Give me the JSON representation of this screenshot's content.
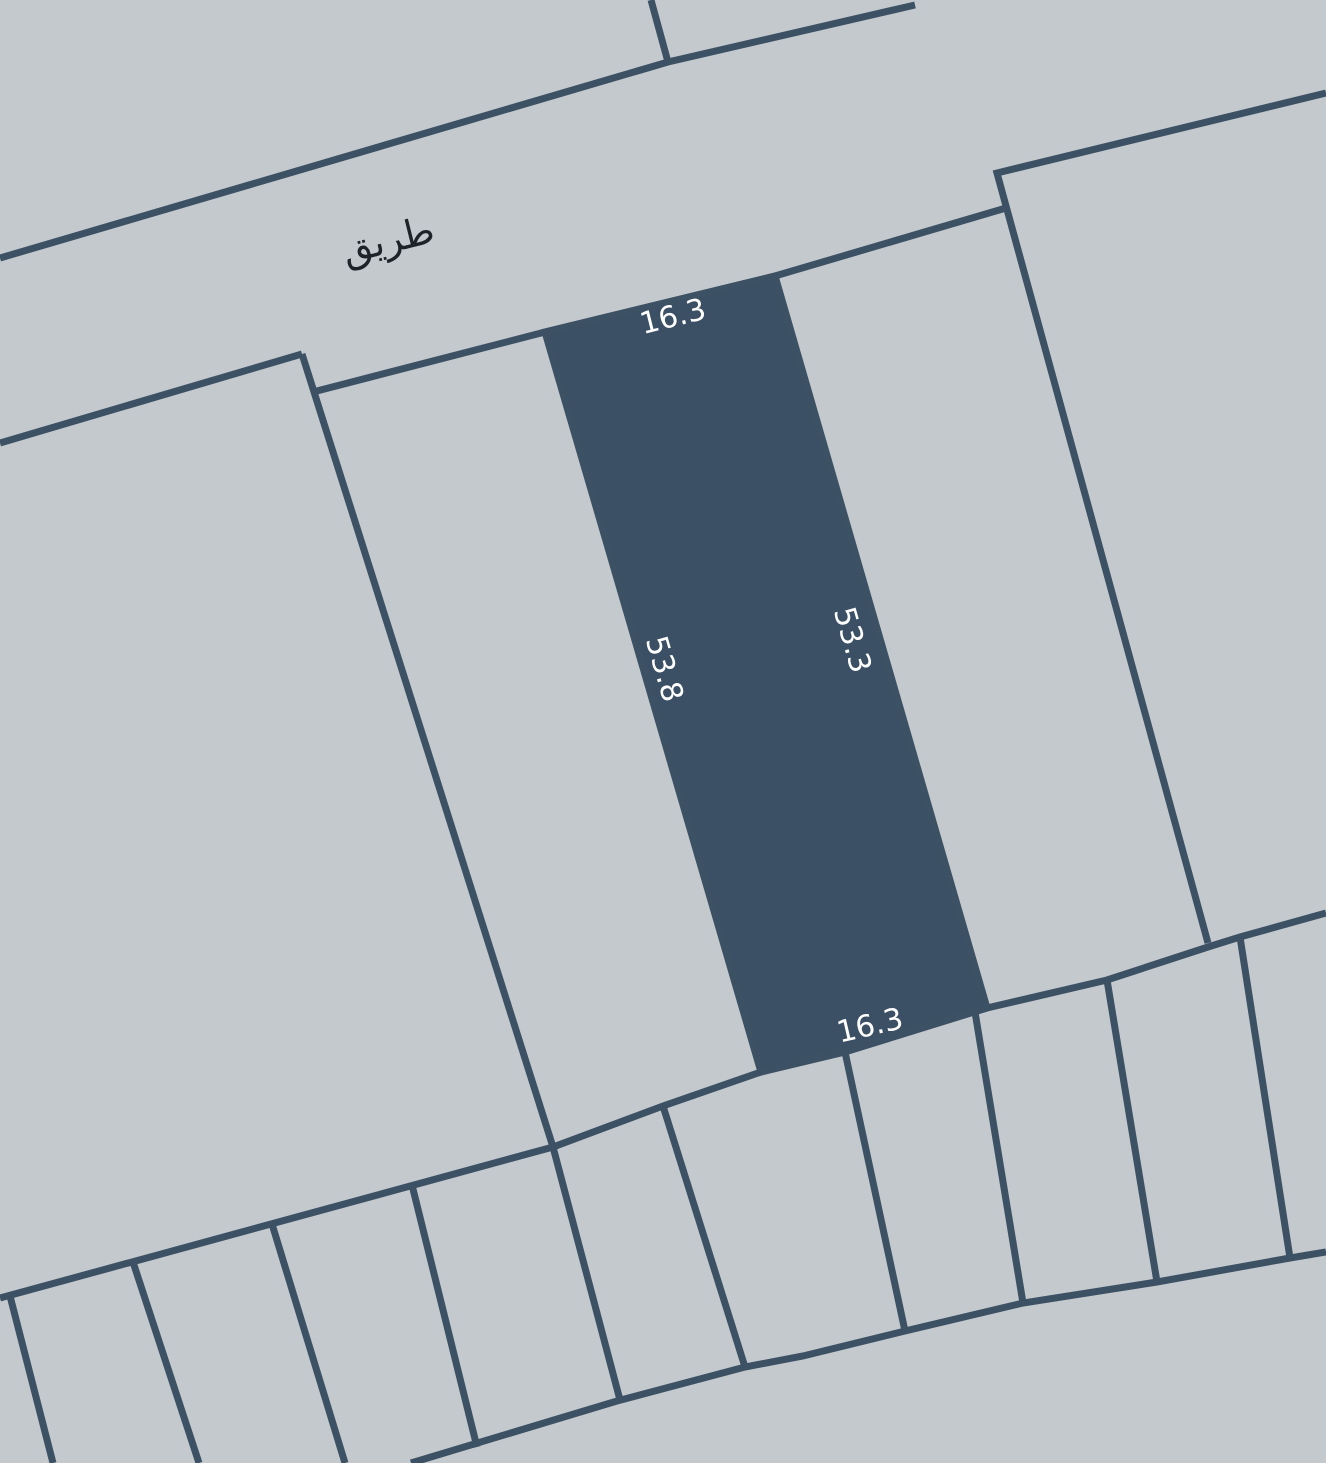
{
  "map": {
    "background_color": "#c4c9cd",
    "boundary_color": "#3d5165",
    "boundary_width": 7,
    "selected_parcel": {
      "fill_color": "#3b5064",
      "points": [
        [
          545,
          332
        ],
        [
          775,
          276
        ],
        [
          987,
          1008
        ],
        [
          761,
          1072
        ]
      ],
      "dimensions": {
        "top": {
          "text": "16.3",
          "x": 673,
          "y": 317,
          "rotate": -14,
          "color": "#ffffff",
          "size": 30
        },
        "right": {
          "text": "53.3",
          "x": 852,
          "y": 640,
          "rotate": 74,
          "color": "#ffffff",
          "size": 30
        },
        "left": {
          "text": "53.8",
          "x": 664,
          "y": 669,
          "rotate": 74,
          "color": "#ffffff",
          "size": 30
        },
        "bottom": {
          "text": "16.3",
          "x": 870,
          "y": 1026,
          "rotate": -13,
          "color": "#ffffff",
          "size": 30
        }
      }
    },
    "road_label": {
      "text": "طريق",
      "x": 388,
      "y": 240,
      "rotate": -14,
      "color": "#1e2329",
      "size": 38
    },
    "boundaries": [
      {
        "id": "road-north-edge",
        "points": [
          [
            0,
            258
          ],
          [
            668,
            62
          ],
          [
            915,
            5
          ]
        ]
      },
      {
        "id": "north-lot-line",
        "points": [
          [
            651,
            0
          ],
          [
            668,
            62
          ]
        ]
      },
      {
        "id": "west-block-north-edge",
        "points": [
          [
            0,
            443
          ],
          [
            302,
            354
          ]
        ]
      },
      {
        "id": "road-south-edge",
        "points": [
          [
            313,
            392
          ],
          [
            545,
            332
          ],
          [
            775,
            276
          ],
          [
            1006,
            208
          ]
        ]
      },
      {
        "id": "east-block-west-edge",
        "points": [
          [
            1326,
            93
          ],
          [
            997,
            173
          ],
          [
            1208,
            943
          ]
        ]
      },
      {
        "id": "west-strip-edge",
        "points": [
          [
            302,
            354
          ],
          [
            553,
            1147
          ]
        ]
      },
      {
        "id": "lower-block-north-edge",
        "points": [
          [
            0,
            1298
          ],
          [
            553,
            1147
          ],
          [
            663,
            1106
          ],
          [
            761,
            1072
          ],
          [
            845,
            1052
          ],
          [
            987,
            1008
          ],
          [
            1107,
            980
          ],
          [
            1208,
            947
          ],
          [
            1240,
            937
          ],
          [
            1326,
            913
          ]
        ]
      },
      {
        "id": "lower-row-south-edge",
        "points": [
          [
            411,
            1463
          ],
          [
            617,
            1401
          ],
          [
            745,
            1367
          ],
          [
            803,
            1356
          ],
          [
            905,
            1331
          ],
          [
            1023,
            1303
          ],
          [
            1157,
            1282
          ],
          [
            1290,
            1258
          ],
          [
            1326,
            1252
          ]
        ]
      },
      {
        "id": "lot-line-1",
        "points": [
          [
            10,
            1296
          ],
          [
            53,
            1463
          ]
        ]
      },
      {
        "id": "lot-line-2",
        "points": [
          [
            133,
            1262
          ],
          [
            199,
            1463
          ]
        ]
      },
      {
        "id": "lot-line-3",
        "points": [
          [
            272,
            1224
          ],
          [
            345,
            1463
          ]
        ]
      },
      {
        "id": "lot-line-4",
        "points": [
          [
            412,
            1185
          ],
          [
            477,
            1447
          ]
        ]
      },
      {
        "id": "lot-line-5",
        "points": [
          [
            553,
            1147
          ],
          [
            620,
            1400
          ]
        ]
      },
      {
        "id": "lot-line-6",
        "points": [
          [
            663,
            1106
          ],
          [
            745,
            1367
          ]
        ]
      },
      {
        "id": "lot-line-7",
        "points": [
          [
            845,
            1052
          ],
          [
            905,
            1331
          ]
        ]
      },
      {
        "id": "lot-line-8",
        "points": [
          [
            975,
            1012
          ],
          [
            1023,
            1303
          ]
        ]
      },
      {
        "id": "lot-line-9",
        "points": [
          [
            1107,
            980
          ],
          [
            1157,
            1282
          ]
        ]
      },
      {
        "id": "lot-line-10",
        "points": [
          [
            1240,
            937
          ],
          [
            1290,
            1258
          ]
        ]
      }
    ]
  }
}
